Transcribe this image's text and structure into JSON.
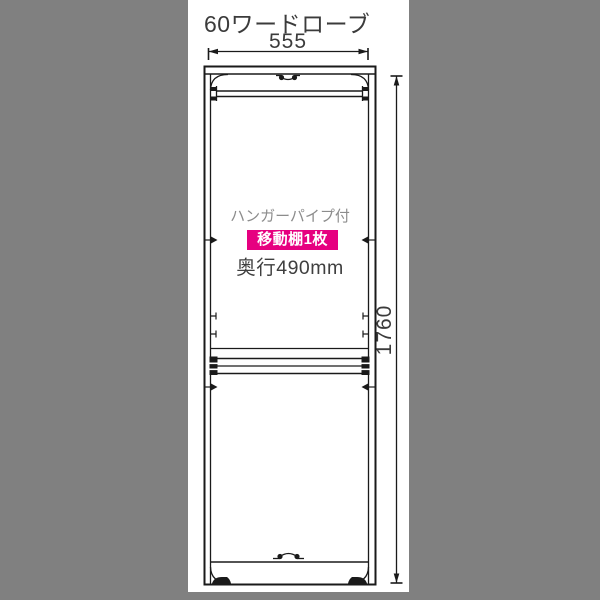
{
  "diagram": {
    "title": "60ワードローブ",
    "width_dim": {
      "label": "555"
    },
    "height_dim": {
      "label": "1760"
    },
    "annotations": {
      "hanger_pipe": "ハンガーパイプ付",
      "movable_shelf": "移動棚1枚",
      "depth": "奥行490mm"
    },
    "colors": {
      "background": "#808080",
      "panel": "#ffffff",
      "line": "#1a1a1a",
      "text_dark": "#3b3b3b",
      "text_gray": "#8c8c8c",
      "badge_bg": "#e60080",
      "badge_text": "#ffffff"
    }
  }
}
